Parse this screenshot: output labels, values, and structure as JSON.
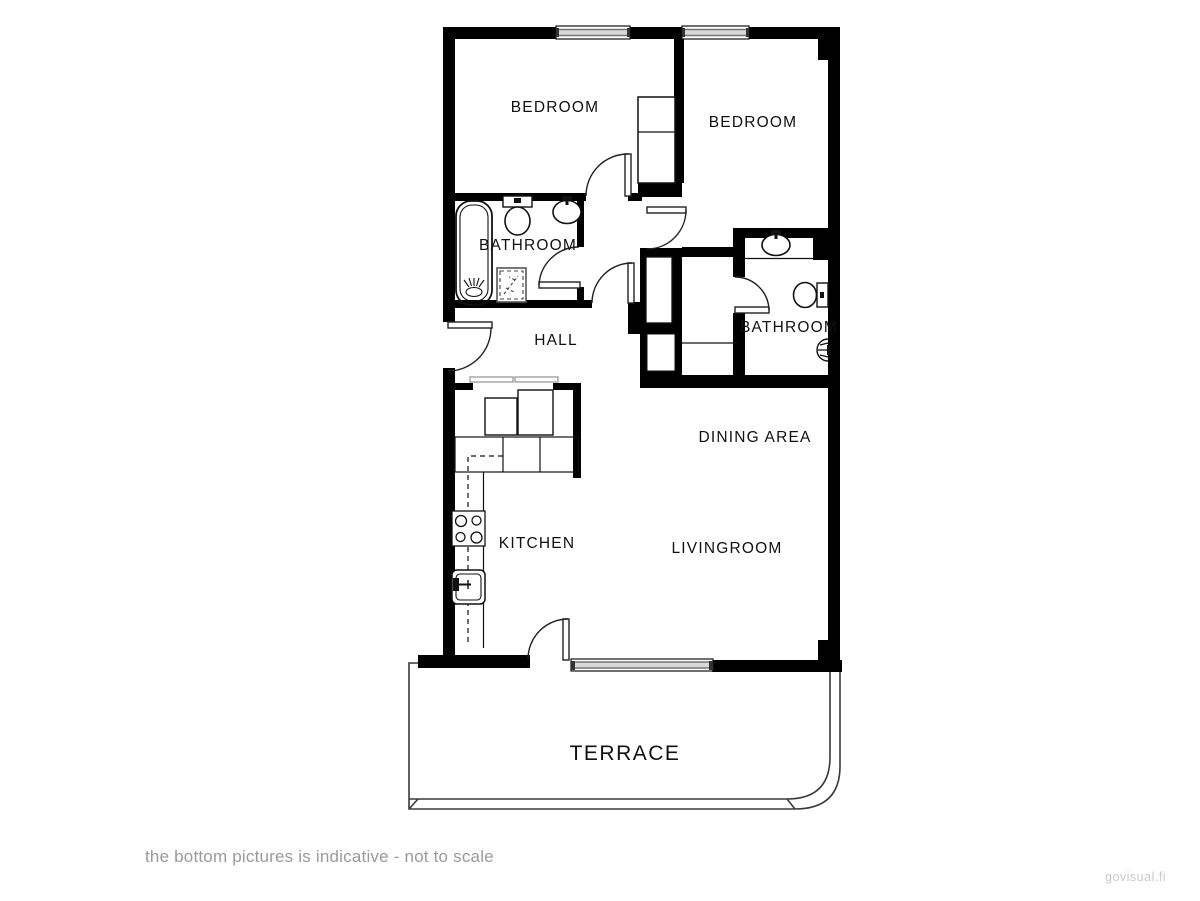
{
  "floor_plan": {
    "labels": {
      "bedroom_left": "BEDROOM",
      "bedroom_right": "BEDROOM",
      "bathroom_left": "BATHROOM",
      "bathroom_right": "BATHROOM",
      "hall": "HALL",
      "dining_area": "DINING AREA",
      "kitchen": "KITCHEN",
      "livingroom": "LIVINGROOM",
      "terrace": "TERRACE"
    },
    "fixture_icons": [
      "bathtub-icon",
      "toilet-icon",
      "washbasin-icon",
      "shower-tray-icon",
      "shower-head-icon",
      "stove-icon",
      "kitchen-sink-icon",
      "wardrobe-icon",
      "sliding-closet-icon",
      "door-swing-icon",
      "window-icon"
    ],
    "colors": {
      "wall": "#000000",
      "label": "#111111",
      "terrace_outline": "#3a3a3a",
      "window_band": "#c2c2c2"
    }
  },
  "caption": "the bottom pictures is indicative - not to scale",
  "watermark": "govisual.fi"
}
